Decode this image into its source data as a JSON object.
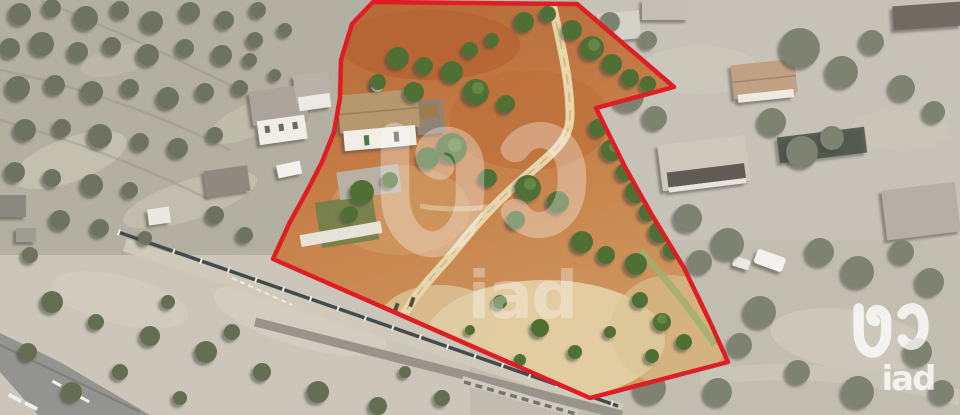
{
  "canvas": {
    "width": 960,
    "height": 415
  },
  "watermark": {
    "brand": "iad",
    "color": "#ffffff",
    "center_opacity": "0.32",
    "corner_opacity": "0.78"
  },
  "boundary": {
    "color": "#df1b21",
    "stroke_width": "4.5",
    "points": "373,2 577,4 674,87 596,108 625,167 652,215 684,268 710,322 728,362 590,398 273,259 290,222 306,193 322,162 334,132 340,98 341,60 352,24"
  },
  "scene": {
    "terrain_inside": "#c67c44",
    "terrain_outside": "#c2bdb1",
    "olive_grove": "#b3b0a1",
    "dirt_path": "#e9d6ab",
    "road": "#97978f",
    "tree_inside": "#4e6e33",
    "tree_outside": "#6d7260"
  }
}
